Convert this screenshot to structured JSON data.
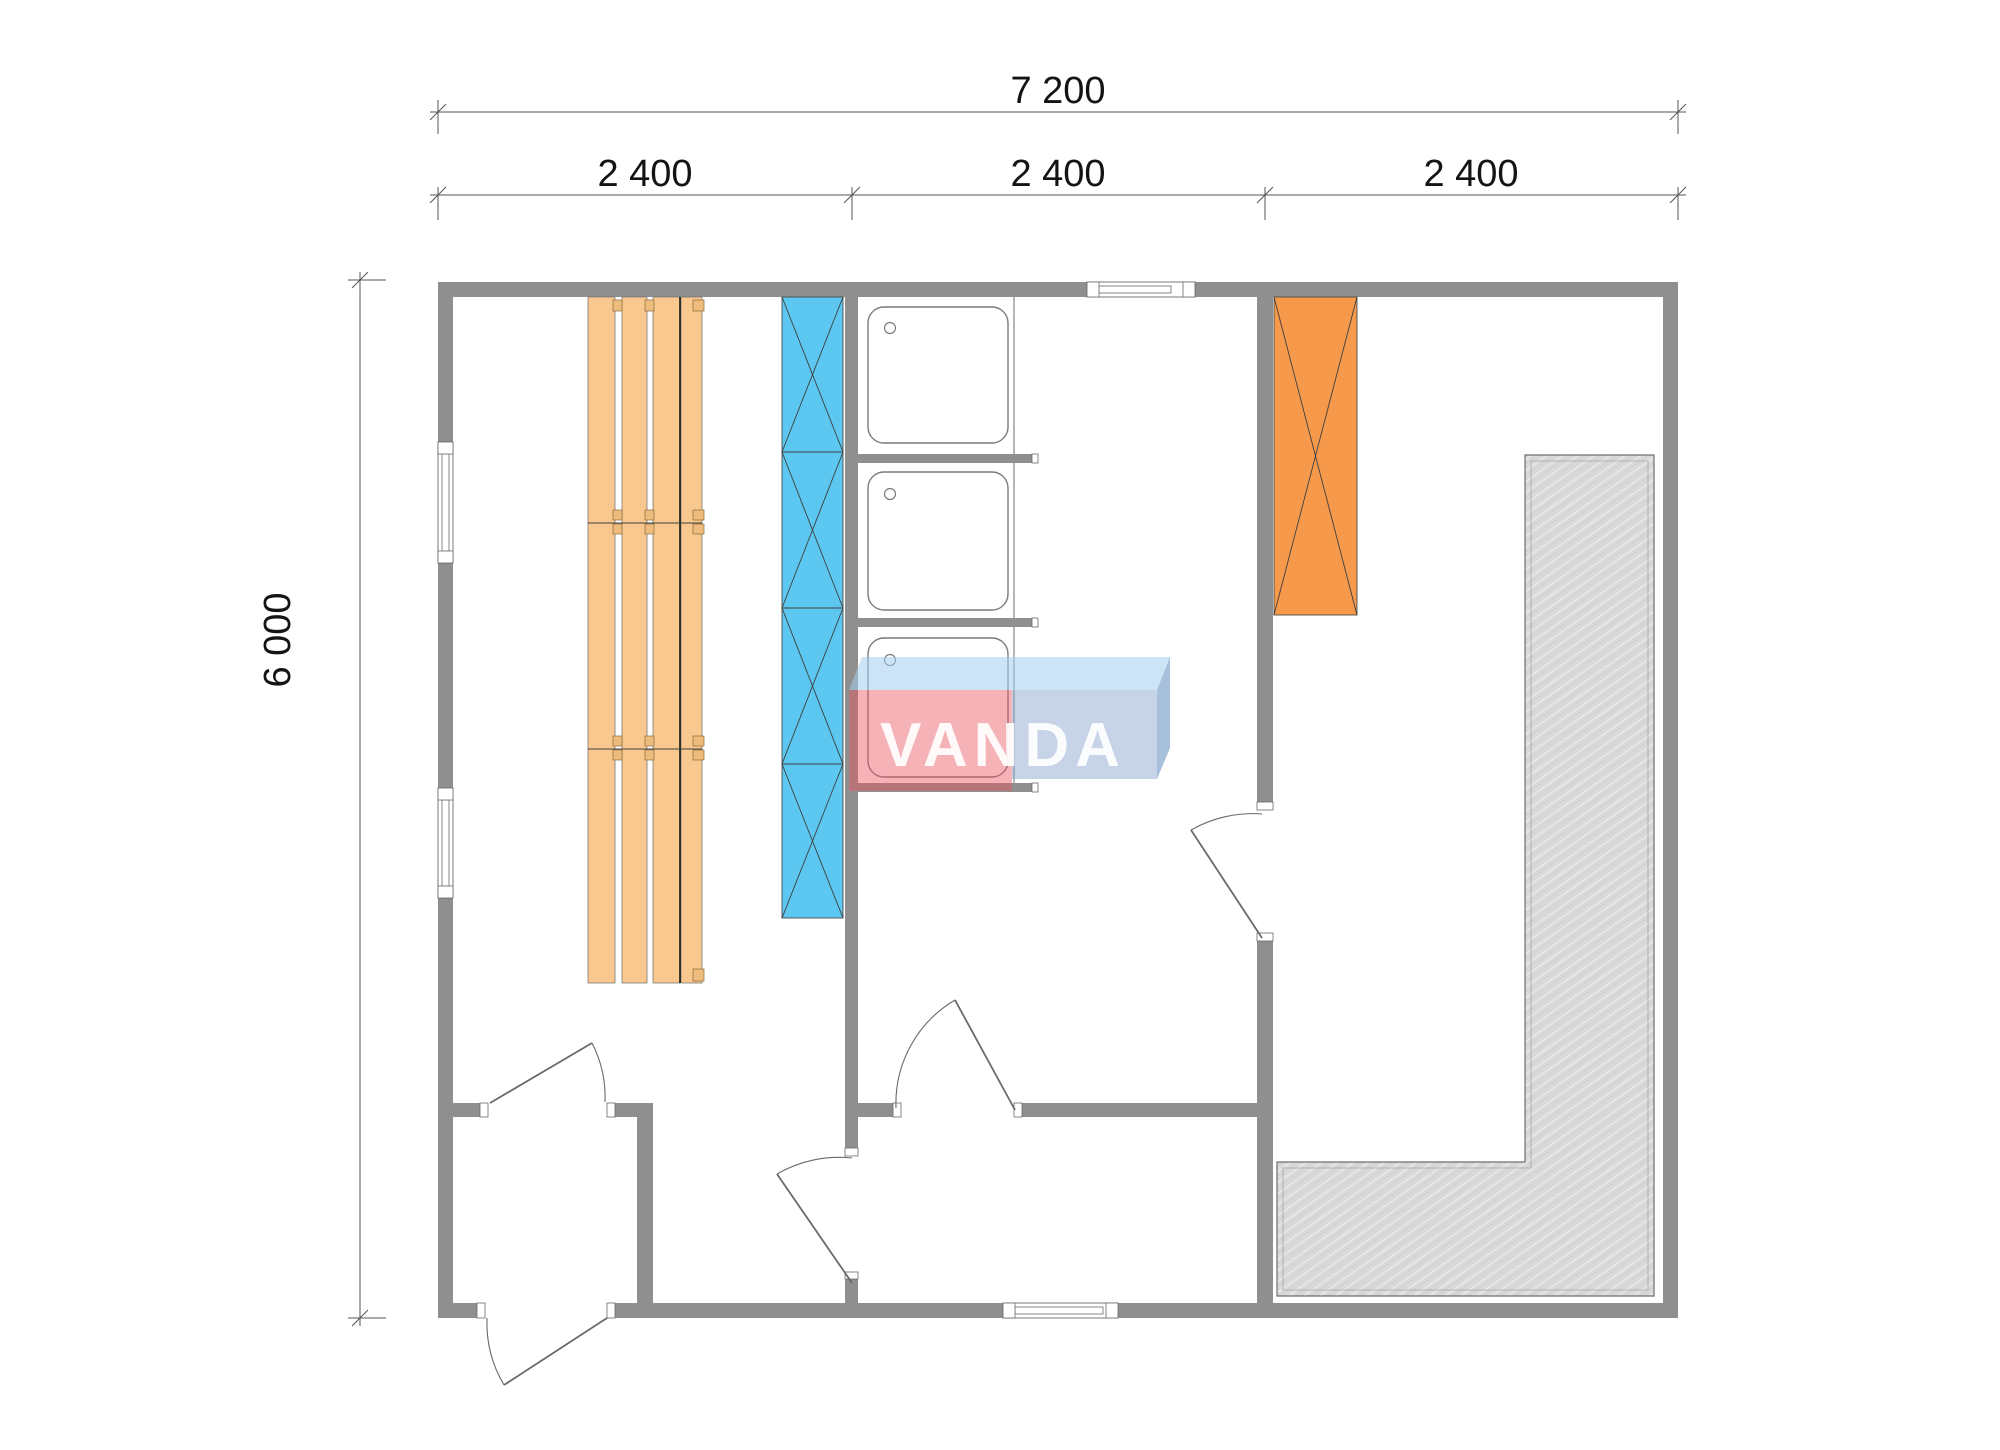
{
  "title": "Sauna cabin floor plan 7200 x 6000",
  "dimensions": {
    "total_width": "7 200",
    "segments": [
      "2 400",
      "2 400",
      "2 400"
    ],
    "height": "6 000"
  },
  "logo": {
    "text": "VANDA"
  },
  "colors": {
    "wall": "#8f8f8f",
    "door_line": "#6a6a6a",
    "bench": "#f9c88e",
    "bench_hook": "#eebd7d",
    "bench_line": "#3f3f3f",
    "heater_blue": "#5cc7f0",
    "cabinet_orange": "#f6994a",
    "hatch_line": "#3f3f3f",
    "terrace": "#d9d9d9",
    "terrace_edge": "#6e6e6e",
    "fixture_line": "#7a7a7a",
    "dim_line": "#555555",
    "dim_text": "#141414",
    "logo_top": "rgba(164,205,238,0.55)",
    "logo_pink": "rgba(233,86,97,0.45)",
    "logo_blue": "rgba(130,160,205,0.45)",
    "logo_side": "rgba(95,140,190,0.55)",
    "logo_text": "rgba(255,255,255,0.92)"
  },
  "symbols": {
    "window-icon": "white break in wall with double frame lines",
    "door-icon": "leaf line with quarter-circle swing arc",
    "shower-tray-icon": "rounded square with drain circle",
    "bench-icon": "orange plank strips with hooks",
    "heater-icon": "blue strip with X cross bracing",
    "cabinet-icon": "orange rectangle with X cross",
    "terrace-icon": "gray diagonal-hatched deck"
  }
}
